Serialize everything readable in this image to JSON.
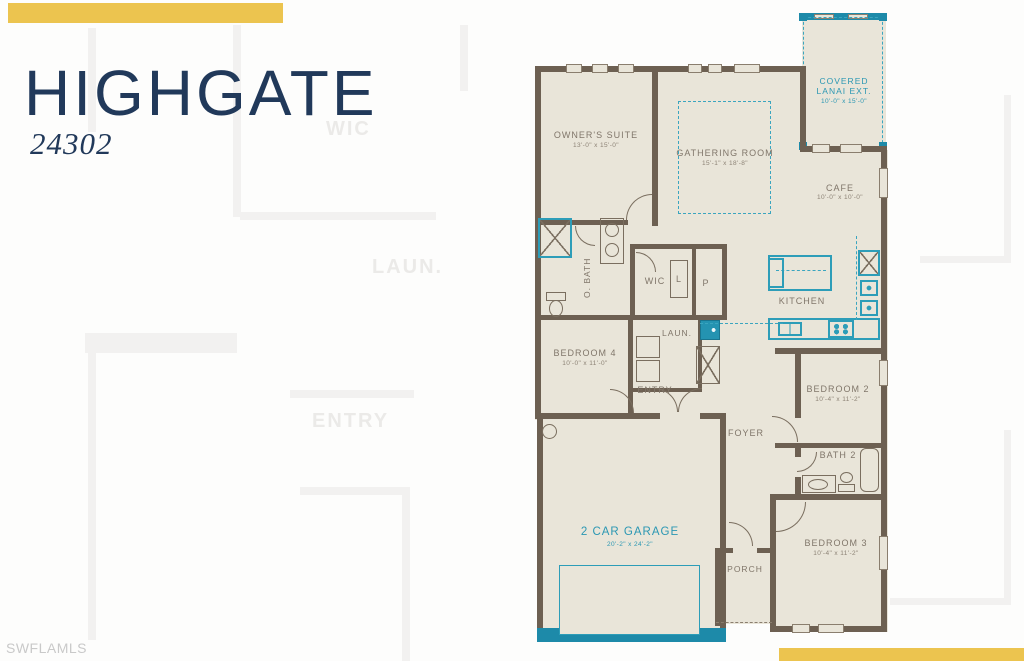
{
  "header": {
    "title": "HIGHGATE",
    "plan_number": "24302"
  },
  "watermark": "SWFLAMLS",
  "colors": {
    "accent_gold": "#ecc44f",
    "title_navy": "#21395a",
    "plan_teal": "#2493b1",
    "wall_brown": "#6d6052",
    "floor_beige": "#e9e5d9",
    "label_gray": "#80766a",
    "watermark_gray": "#c9c9c9"
  },
  "ghost_labels": {
    "wic": "WIC",
    "laundry": "LAUN.",
    "entry": "ENTRY"
  },
  "rooms": {
    "owners_suite": {
      "label": "OWNER'S SUITE",
      "dims": "13'-0\" x 15'-0\""
    },
    "gathering_room": {
      "label": "GATHERING ROOM",
      "dims": "15'-1\" x 18'-8\""
    },
    "covered_lanai": {
      "label": "COVERED LANAI EXT.",
      "dims": "10'-0\" x 15'-0\""
    },
    "cafe": {
      "label": "CAFE",
      "dims": "10'-0\" x 10'-0\""
    },
    "kitchen": {
      "label": "KITCHEN"
    },
    "owners_bath": {
      "label": "O. BATH"
    },
    "wic": {
      "label": "WIC"
    },
    "linen": {
      "label": "L"
    },
    "pantry": {
      "label": "P"
    },
    "laundry": {
      "label": "LAUN."
    },
    "bedroom4": {
      "label": "BEDROOM 4",
      "dims": "10'-0\" x 11'-0\""
    },
    "entry": {
      "label": "ENTRY"
    },
    "foyer": {
      "label": "FOYER"
    },
    "bedroom2": {
      "label": "BEDROOM 2",
      "dims": "10'-4\" x 11'-2\""
    },
    "bath2": {
      "label": "BATH 2"
    },
    "bedroom3": {
      "label": "BEDROOM 3",
      "dims": "10'-4\" x 11'-2\""
    },
    "garage": {
      "label": "2 CAR GARAGE",
      "dims": "20'-2\" x 24'-2\""
    },
    "porch": {
      "label": "PORCH"
    }
  },
  "fixtures": {
    "shower": "x-box-teal-frame",
    "fridge": "x-box",
    "coat_closet": "x-box",
    "washer_dryer": "stacked-squares",
    "island": "teal-rect",
    "dishwasher": "teal-square",
    "garage_door": "teal-outline",
    "water_heater": "circle",
    "tub": "rounded-rect",
    "toilet": "oval",
    "sinks": "circles"
  }
}
